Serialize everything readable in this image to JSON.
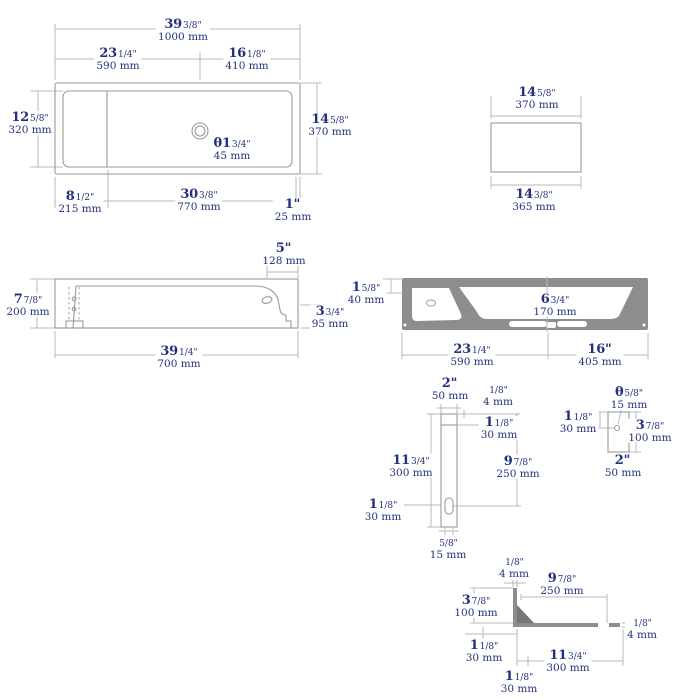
{
  "drawing": {
    "title": "sink-dimension-drawing",
    "text_color": "#23307e",
    "dim_line_color": "#b9b9b9",
    "outline_color": "#999999",
    "section_fill_color": "#8d8d8d"
  },
  "labels": [
    {
      "id": "topview-overall-width",
      "x": 183,
      "y": 30,
      "big": "39",
      "small": "3/8\"",
      "mm": "1000 mm"
    },
    {
      "id": "topview-left-width",
      "x": 118,
      "y": 59,
      "big": "23",
      "small": "1/4\"",
      "mm": "590 mm"
    },
    {
      "id": "topview-right-width",
      "x": 247,
      "y": 59,
      "big": "16",
      "small": "1/8\"",
      "mm": "410 mm"
    },
    {
      "id": "topview-inner-depth",
      "x": 30,
      "y": 123,
      "big": "12",
      "small": "5/8\"",
      "mm": "320 mm"
    },
    {
      "id": "topview-outer-depth",
      "x": 330,
      "y": 125,
      "big": "14",
      "small": "5/8\"",
      "mm": "370 mm"
    },
    {
      "id": "topview-shelf-width",
      "x": 80,
      "y": 202,
      "big": "8",
      "small": "1/2\"",
      "mm": "215 mm"
    },
    {
      "id": "topview-basin-width",
      "x": 199,
      "y": 200,
      "big": "30",
      "small": "3/8\"",
      "mm": "770 mm"
    },
    {
      "id": "topview-edge",
      "x": 293,
      "y": 210,
      "big": "1\"",
      "small": "",
      "mm": "25 mm"
    },
    {
      "id": "topview-drain-diameter",
      "x": 232,
      "y": 149,
      "big": "θ1",
      "small": "3/4\"",
      "mm": "45 mm"
    },
    {
      "id": "sideview-top-width",
      "x": 537,
      "y": 98,
      "big": "14",
      "small": "5/8\"",
      "mm": "370 mm"
    },
    {
      "id": "sideview-bottom-width",
      "x": 534,
      "y": 200,
      "big": "14",
      "small": "3/8\"",
      "mm": "365 mm"
    },
    {
      "id": "frontview-height",
      "x": 28,
      "y": 305,
      "big": "7",
      "small": "7/8\"",
      "mm": "200 mm"
    },
    {
      "id": "frontview-top-right",
      "x": 284,
      "y": 254,
      "big": "5\"",
      "small": "",
      "mm": "128 mm"
    },
    {
      "id": "frontview-right-height",
      "x": 330,
      "y": 317,
      "big": "3",
      "small": "3/4\"",
      "mm": "95 mm"
    },
    {
      "id": "frontview-width",
      "x": 179,
      "y": 357,
      "big": "39",
      "small": "1/4\"",
      "mm": "700 mm"
    },
    {
      "id": "section-rim-height",
      "x": 366,
      "y": 293,
      "big": "1",
      "small": "5/8\"",
      "mm": "40 mm"
    },
    {
      "id": "section-basin-depth",
      "x": 555,
      "y": 305,
      "big": "6",
      "small": "3/4\"",
      "mm": "170 mm"
    },
    {
      "id": "section-left-width",
      "x": 472,
      "y": 355,
      "big": "23",
      "small": "1/4\"",
      "mm": "590 mm"
    },
    {
      "id": "section-right-width",
      "x": 600,
      "y": 355,
      "big": "16\"",
      "small": "",
      "mm": "405 mm"
    },
    {
      "id": "bracket-top-width",
      "x": 450,
      "y": 389,
      "big": "2\"",
      "small": "",
      "mm": "50 mm"
    },
    {
      "id": "bracket-top-lip",
      "x": 498,
      "y": 395,
      "big": "",
      "small": "1/8\"",
      "mm": "4 mm"
    },
    {
      "id": "bracket-top-offset",
      "x": 499,
      "y": 428,
      "big": "1",
      "small": "1/8\"",
      "mm": "30 mm"
    },
    {
      "id": "bracket-height",
      "x": 411,
      "y": 466,
      "big": "11",
      "small": "3/4\"",
      "mm": "300 mm"
    },
    {
      "id": "bracket-slot-center",
      "x": 518,
      "y": 467,
      "big": "9",
      "small": "7/8\"",
      "mm": "250 mm"
    },
    {
      "id": "bracket-slot-left",
      "x": 383,
      "y": 510,
      "big": "1",
      "small": "1/8\"",
      "mm": "30 mm"
    },
    {
      "id": "bracket-slot-width",
      "x": 448,
      "y": 548,
      "big": "",
      "small": "5/8\"",
      "mm": "15 mm"
    },
    {
      "id": "plate-hole-diameter",
      "x": 629,
      "y": 398,
      "big": "θ",
      "small": "5/8\"",
      "mm": "15 mm"
    },
    {
      "id": "plate-hole-offset",
      "x": 578,
      "y": 422,
      "big": "1",
      "small": "1/8\"",
      "mm": "30 mm"
    },
    {
      "id": "plate-height",
      "x": 650,
      "y": 431,
      "big": "3",
      "small": "7/8\"",
      "mm": "100 mm"
    },
    {
      "id": "plate-width",
      "x": 623,
      "y": 466,
      "big": "2\"",
      "small": "",
      "mm": "50 mm"
    },
    {
      "id": "angle-top-thickness",
      "x": 514,
      "y": 567,
      "big": "",
      "small": "1/8\"",
      "mm": "4 mm"
    },
    {
      "id": "angle-arm-top",
      "x": 562,
      "y": 584,
      "big": "9",
      "small": "7/8\"",
      "mm": "250 mm"
    },
    {
      "id": "angle-leg-height",
      "x": 476,
      "y": 606,
      "big": "3",
      "small": "7/8\"",
      "mm": "100 mm"
    },
    {
      "id": "angle-leg-offset",
      "x": 484,
      "y": 651,
      "big": "1",
      "small": "1/8\"",
      "mm": "30 mm"
    },
    {
      "id": "angle-right-thickness",
      "x": 642,
      "y": 628,
      "big": "",
      "small": "1/8\"",
      "mm": "4 mm"
    },
    {
      "id": "angle-arm-bottom",
      "x": 568,
      "y": 661,
      "big": "11",
      "small": "3/4\"",
      "mm": "300 mm"
    },
    {
      "id": "angle-bottom-offset",
      "x": 519,
      "y": 682,
      "big": "1",
      "small": "1/8\"",
      "mm": "30 mm"
    }
  ]
}
